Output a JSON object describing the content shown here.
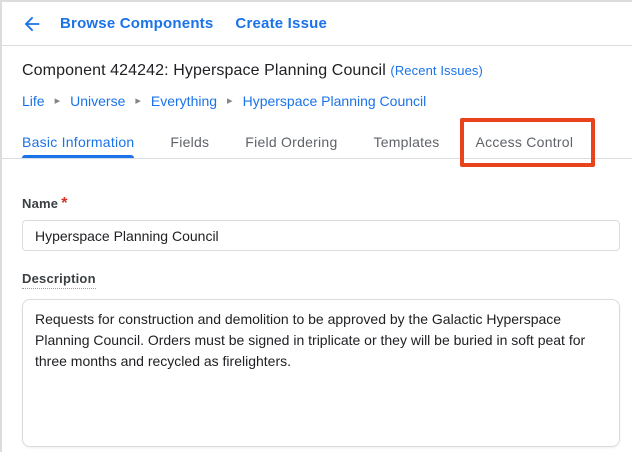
{
  "topbar": {
    "browse_components_label": "Browse Components",
    "create_issue_label": "Create Issue"
  },
  "header": {
    "title": "Component 424242: Hyperspace Planning Council",
    "recent_issues_label": "(Recent Issues)"
  },
  "breadcrumb": {
    "separator": "▸",
    "items": [
      {
        "label": "Life"
      },
      {
        "label": "Universe"
      },
      {
        "label": "Everything"
      },
      {
        "label": "Hyperspace Planning Council"
      }
    ]
  },
  "tabs": [
    {
      "label": "Basic Information",
      "active": true
    },
    {
      "label": "Fields",
      "active": false
    },
    {
      "label": "Field Ordering",
      "active": false
    },
    {
      "label": "Templates",
      "active": false
    },
    {
      "label": "Access Control",
      "active": false,
      "highlighted": true
    }
  ],
  "form": {
    "name": {
      "label": "Name",
      "required_marker": "*",
      "value": "Hyperspace Planning Council"
    },
    "description": {
      "label": "Description",
      "value": "Requests for construction and demolition to be approved by the Galactic Hyperspace Planning Council. Orders must be signed in triplicate or they will be buried in soft peat for three months and recycled as firelighters."
    }
  },
  "colors": {
    "link_blue": "#1a73e8",
    "highlight_red": "#e8431c",
    "required_red": "#d93025",
    "border_gray": "#dadce0"
  }
}
